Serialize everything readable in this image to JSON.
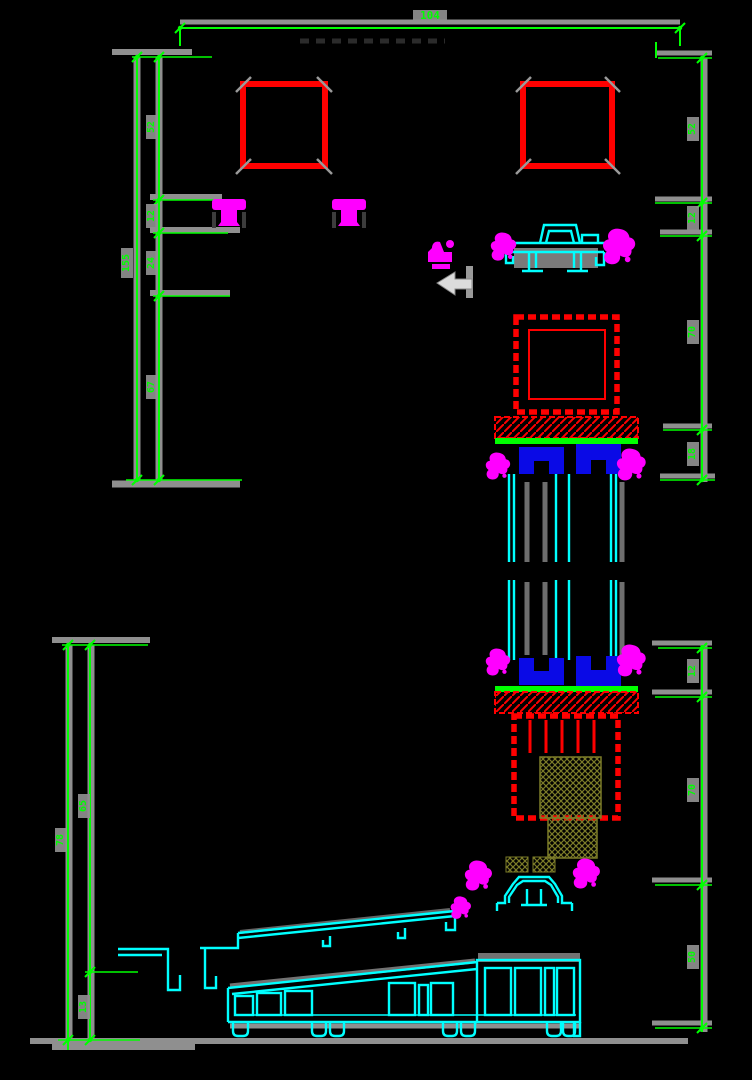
{
  "palette": {
    "bg": "#000000",
    "dim": "#00ff00",
    "profile": "#00ffff",
    "steel": "#ff0000",
    "gasket": "#ff00ff",
    "glass_fill": "#0a0ae6",
    "olive": "#7c7c28",
    "halo": "#8f8f8f",
    "arrow": "#dcdcdc"
  },
  "dimensions": {
    "top": {
      "width": "104"
    },
    "upper_left": {
      "total": "155",
      "segments": [
        "52",
        "12",
        "24",
        "67"
      ]
    },
    "upper_right": {
      "segments": [
        "52",
        "12",
        "70",
        "18"
      ]
    },
    "lower_left": {
      "total": "78",
      "segments": [
        "65",
        "13"
      ]
    },
    "lower_right": {
      "segments": [
        "12",
        "70",
        "50"
      ]
    }
  }
}
